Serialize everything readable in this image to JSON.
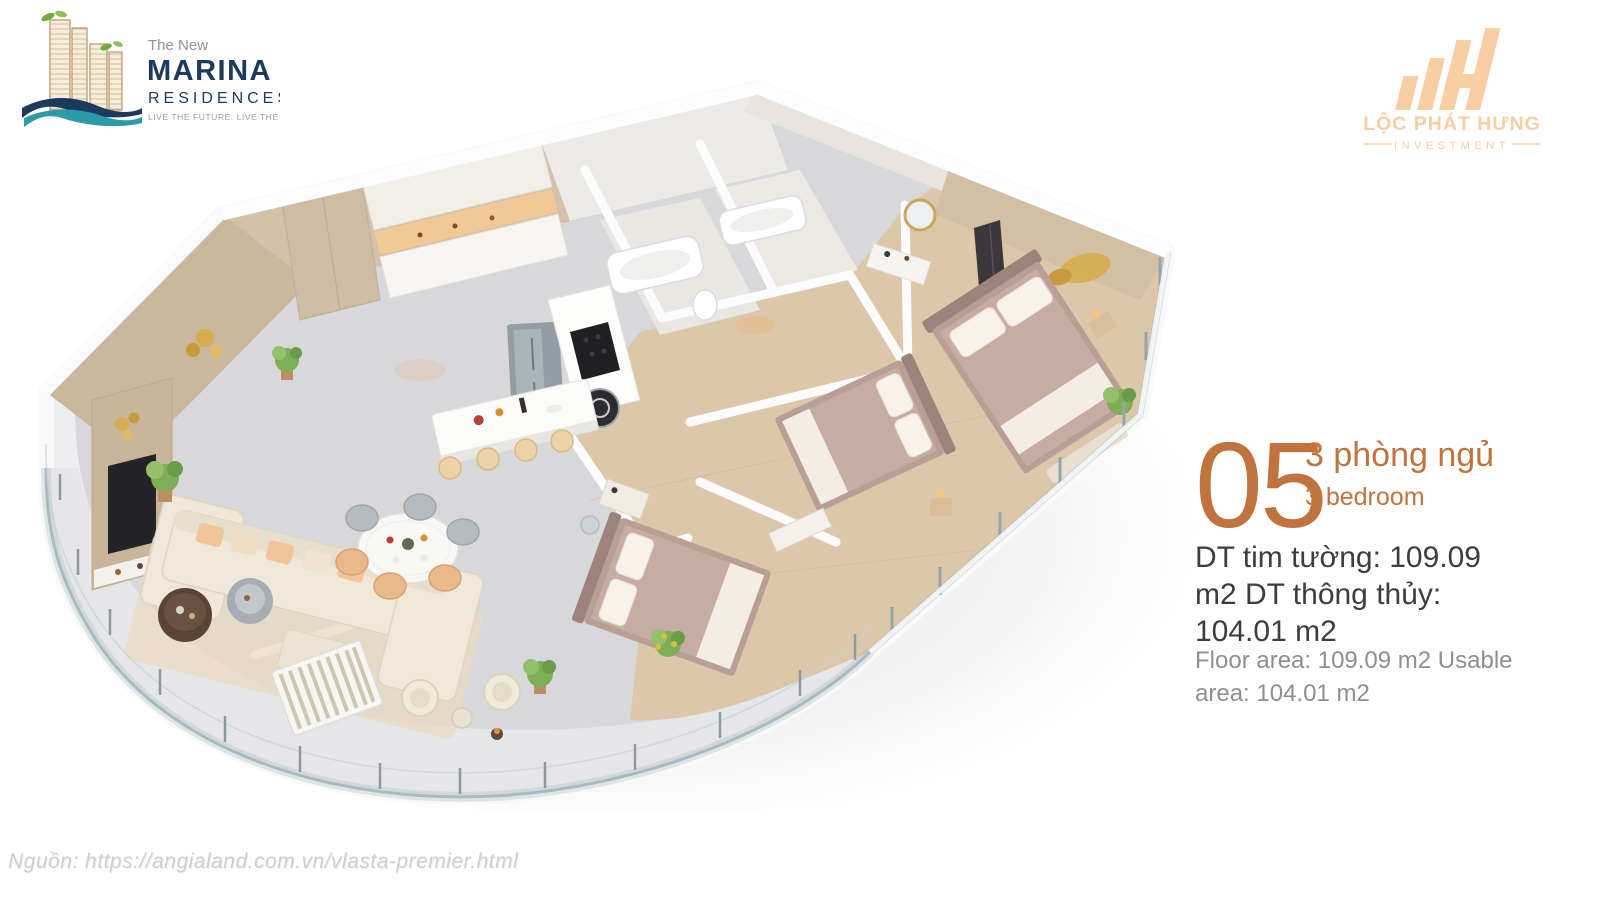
{
  "brand_left": {
    "pre": "The New",
    "name": "MARINA",
    "sub": "RESIDENCES",
    "tagline": "LIVE THE FUTURE. LIVE THE VIEW.",
    "colors": {
      "navy": "#1d3a5e",
      "teal": "#2b9aaa",
      "tan": "#c4a177",
      "leaf": "#6fae3e",
      "gray": "#8c929c"
    }
  },
  "brand_right": {
    "name": "LỘC PHÁT HƯNG",
    "sub": "INVESTMENT",
    "color": "#f8cea3"
  },
  "unit": {
    "number": "05",
    "bedrooms_vi": "3 phòng ngủ",
    "bedrooms_en": "3 bedroom",
    "area_vi": "DT tim tường: 109.09 m2 DT thông thủy: 104.01 m2",
    "area_en": "Floor area: 109.09 m2 Usable area: 104.01 m2",
    "accent": "#c1733e",
    "text_dark": "#3d3d3f",
    "text_gray": "#8e8f91"
  },
  "source": "Nguồn: https://angialand.com.vn/vlasta-premier.html"
}
